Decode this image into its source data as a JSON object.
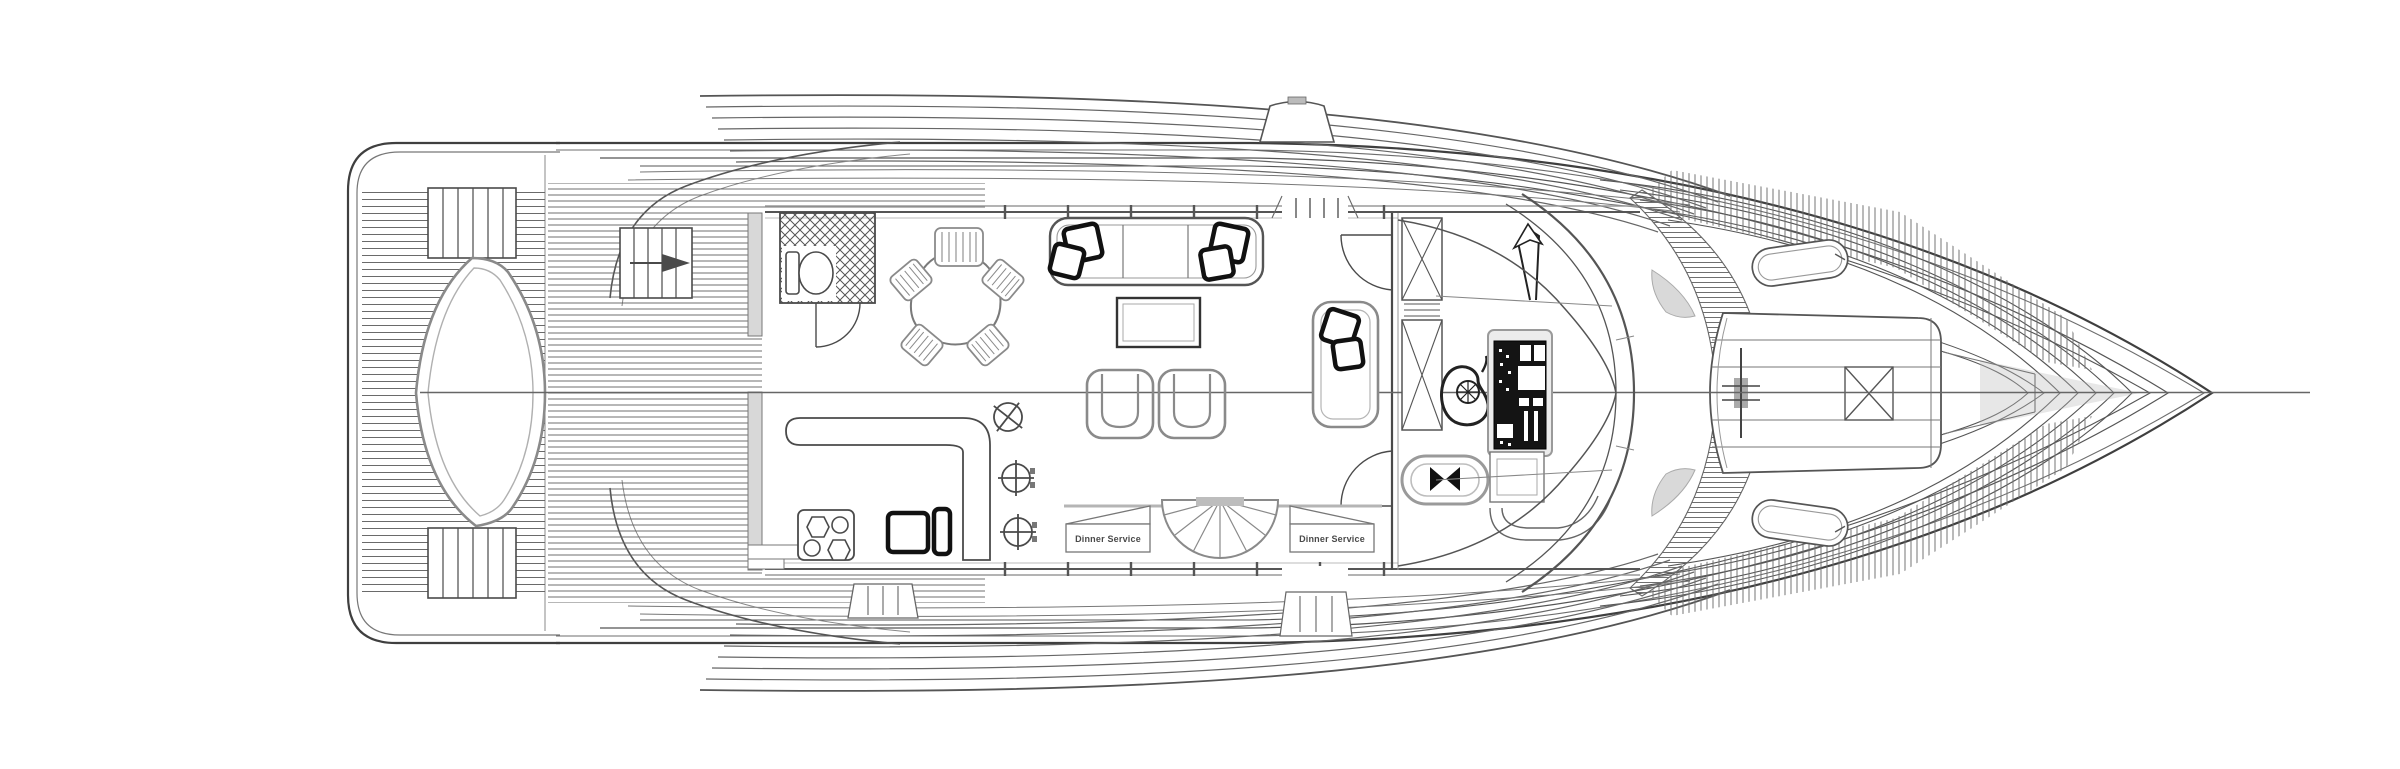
{
  "page": {
    "background": "#ffffff"
  },
  "drawing": {
    "type": "yacht-main-deck-plan",
    "orientation": "bow-right",
    "stair_labels": {
      "left": "Dinner Service",
      "right": "Dinner Service"
    },
    "colors": {
      "ink": "#3f3f3f",
      "ink_light": "#9a9a9a",
      "cushion_grey": "#d2d2d2",
      "panel_black": "#141414",
      "label_text": "#4a4a4a"
    },
    "icons": [
      "toilet-icon",
      "shower-hatch-icon",
      "dining-table-icon",
      "dining-chair-icon",
      "sofa-icon",
      "pillow-icon",
      "coffee-table-icon",
      "club-chair-icon",
      "armchair-icon",
      "stove-icon",
      "fridge-icon",
      "deck-light-icon",
      "spiral-stair-icon",
      "steering-wheel-icon",
      "helm-console-icon",
      "helm-seat-icon",
      "anchor-windlass-icon",
      "deck-hatch-icon",
      "radar-arch-icon",
      "boarding-gate-icon"
    ]
  }
}
